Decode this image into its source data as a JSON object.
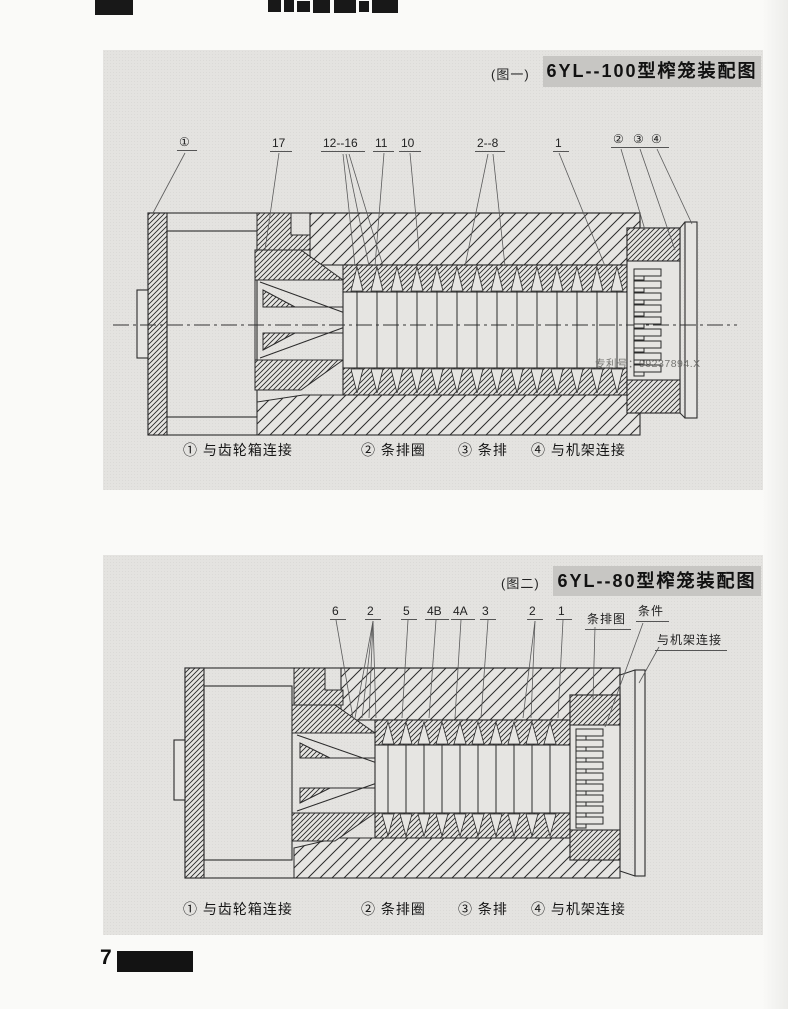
{
  "page": {
    "number": "7",
    "watermark": "专利号：99237894.X"
  },
  "figure1": {
    "caption": "(图一)",
    "title": "6YL--100型榨笼装配图",
    "labels": {
      "l1": "①",
      "l2": "17",
      "l3": "12--16",
      "l4": "11",
      "l5": "10",
      "l6": "2--8",
      "l7": "1",
      "l8": "②",
      "l9": "③",
      "l10": "④"
    },
    "legend": {
      "item1": "① 与齿轮箱连接",
      "item2": "② 条排圈",
      "item3": "③ 条排",
      "item4": "④ 与机架连接"
    }
  },
  "figure2": {
    "caption": "(图二)",
    "title": "6YL--80型榨笼装配图",
    "labels": {
      "l1": "6",
      "l2": "2",
      "l3": "5",
      "l4": "4B",
      "l5": "4A",
      "l6": "3",
      "l7": "2",
      "l8": "1"
    },
    "callouts": {
      "c1": "条排图",
      "c2": "条件",
      "c3": "与机架连接"
    },
    "legend": {
      "item1": "① 与齿轮箱连接",
      "item2": "② 条排圈",
      "item3": "③ 条排",
      "item4": "④ 与机架连接"
    }
  },
  "colors": {
    "panel_bg": "#e4e3e0",
    "title_bar_bg": "#c7c6c3",
    "line": "#2b2b2b"
  }
}
